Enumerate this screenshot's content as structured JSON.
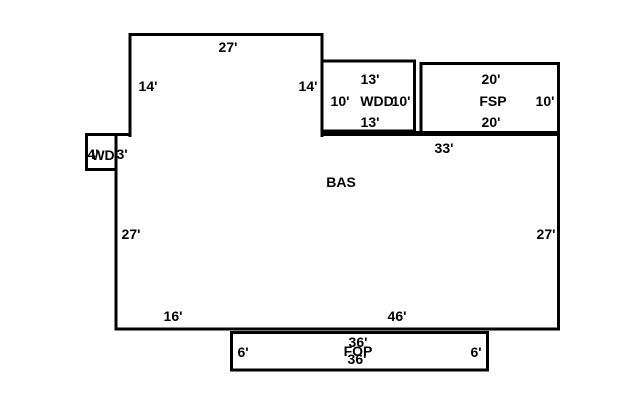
{
  "sketch": {
    "areas": {
      "bas": "BAS",
      "wdd": "WDD",
      "fsp": "FSP",
      "wd": "WD",
      "fop": "FOP"
    },
    "dims": {
      "tower_top_27": "27'",
      "tower_left_14": "14'",
      "tower_right_14": "14'",
      "wdd_top_13": "13'",
      "wdd_left_10": "10'",
      "wdd_right_10": "10'",
      "wdd_bottom_13": "13'",
      "fsp_top_20": "20'",
      "fsp_right_10": "10'",
      "fsp_bottom_20": "20'",
      "bas_top_33": "33'",
      "wd_width_4": "4'",
      "wd_height_3": "3'",
      "bas_left_27": "27'",
      "bas_right_27": "27'",
      "bas_bottom_left_16": "16'",
      "bas_bottom_right_46": "46'",
      "fop_left_6": "6'",
      "fop_right_6": "6'",
      "fop_top_36": "36'",
      "fop_bottom_36": "36'"
    },
    "colors": {
      "line": "#000000",
      "background": "#ffffff"
    }
  }
}
